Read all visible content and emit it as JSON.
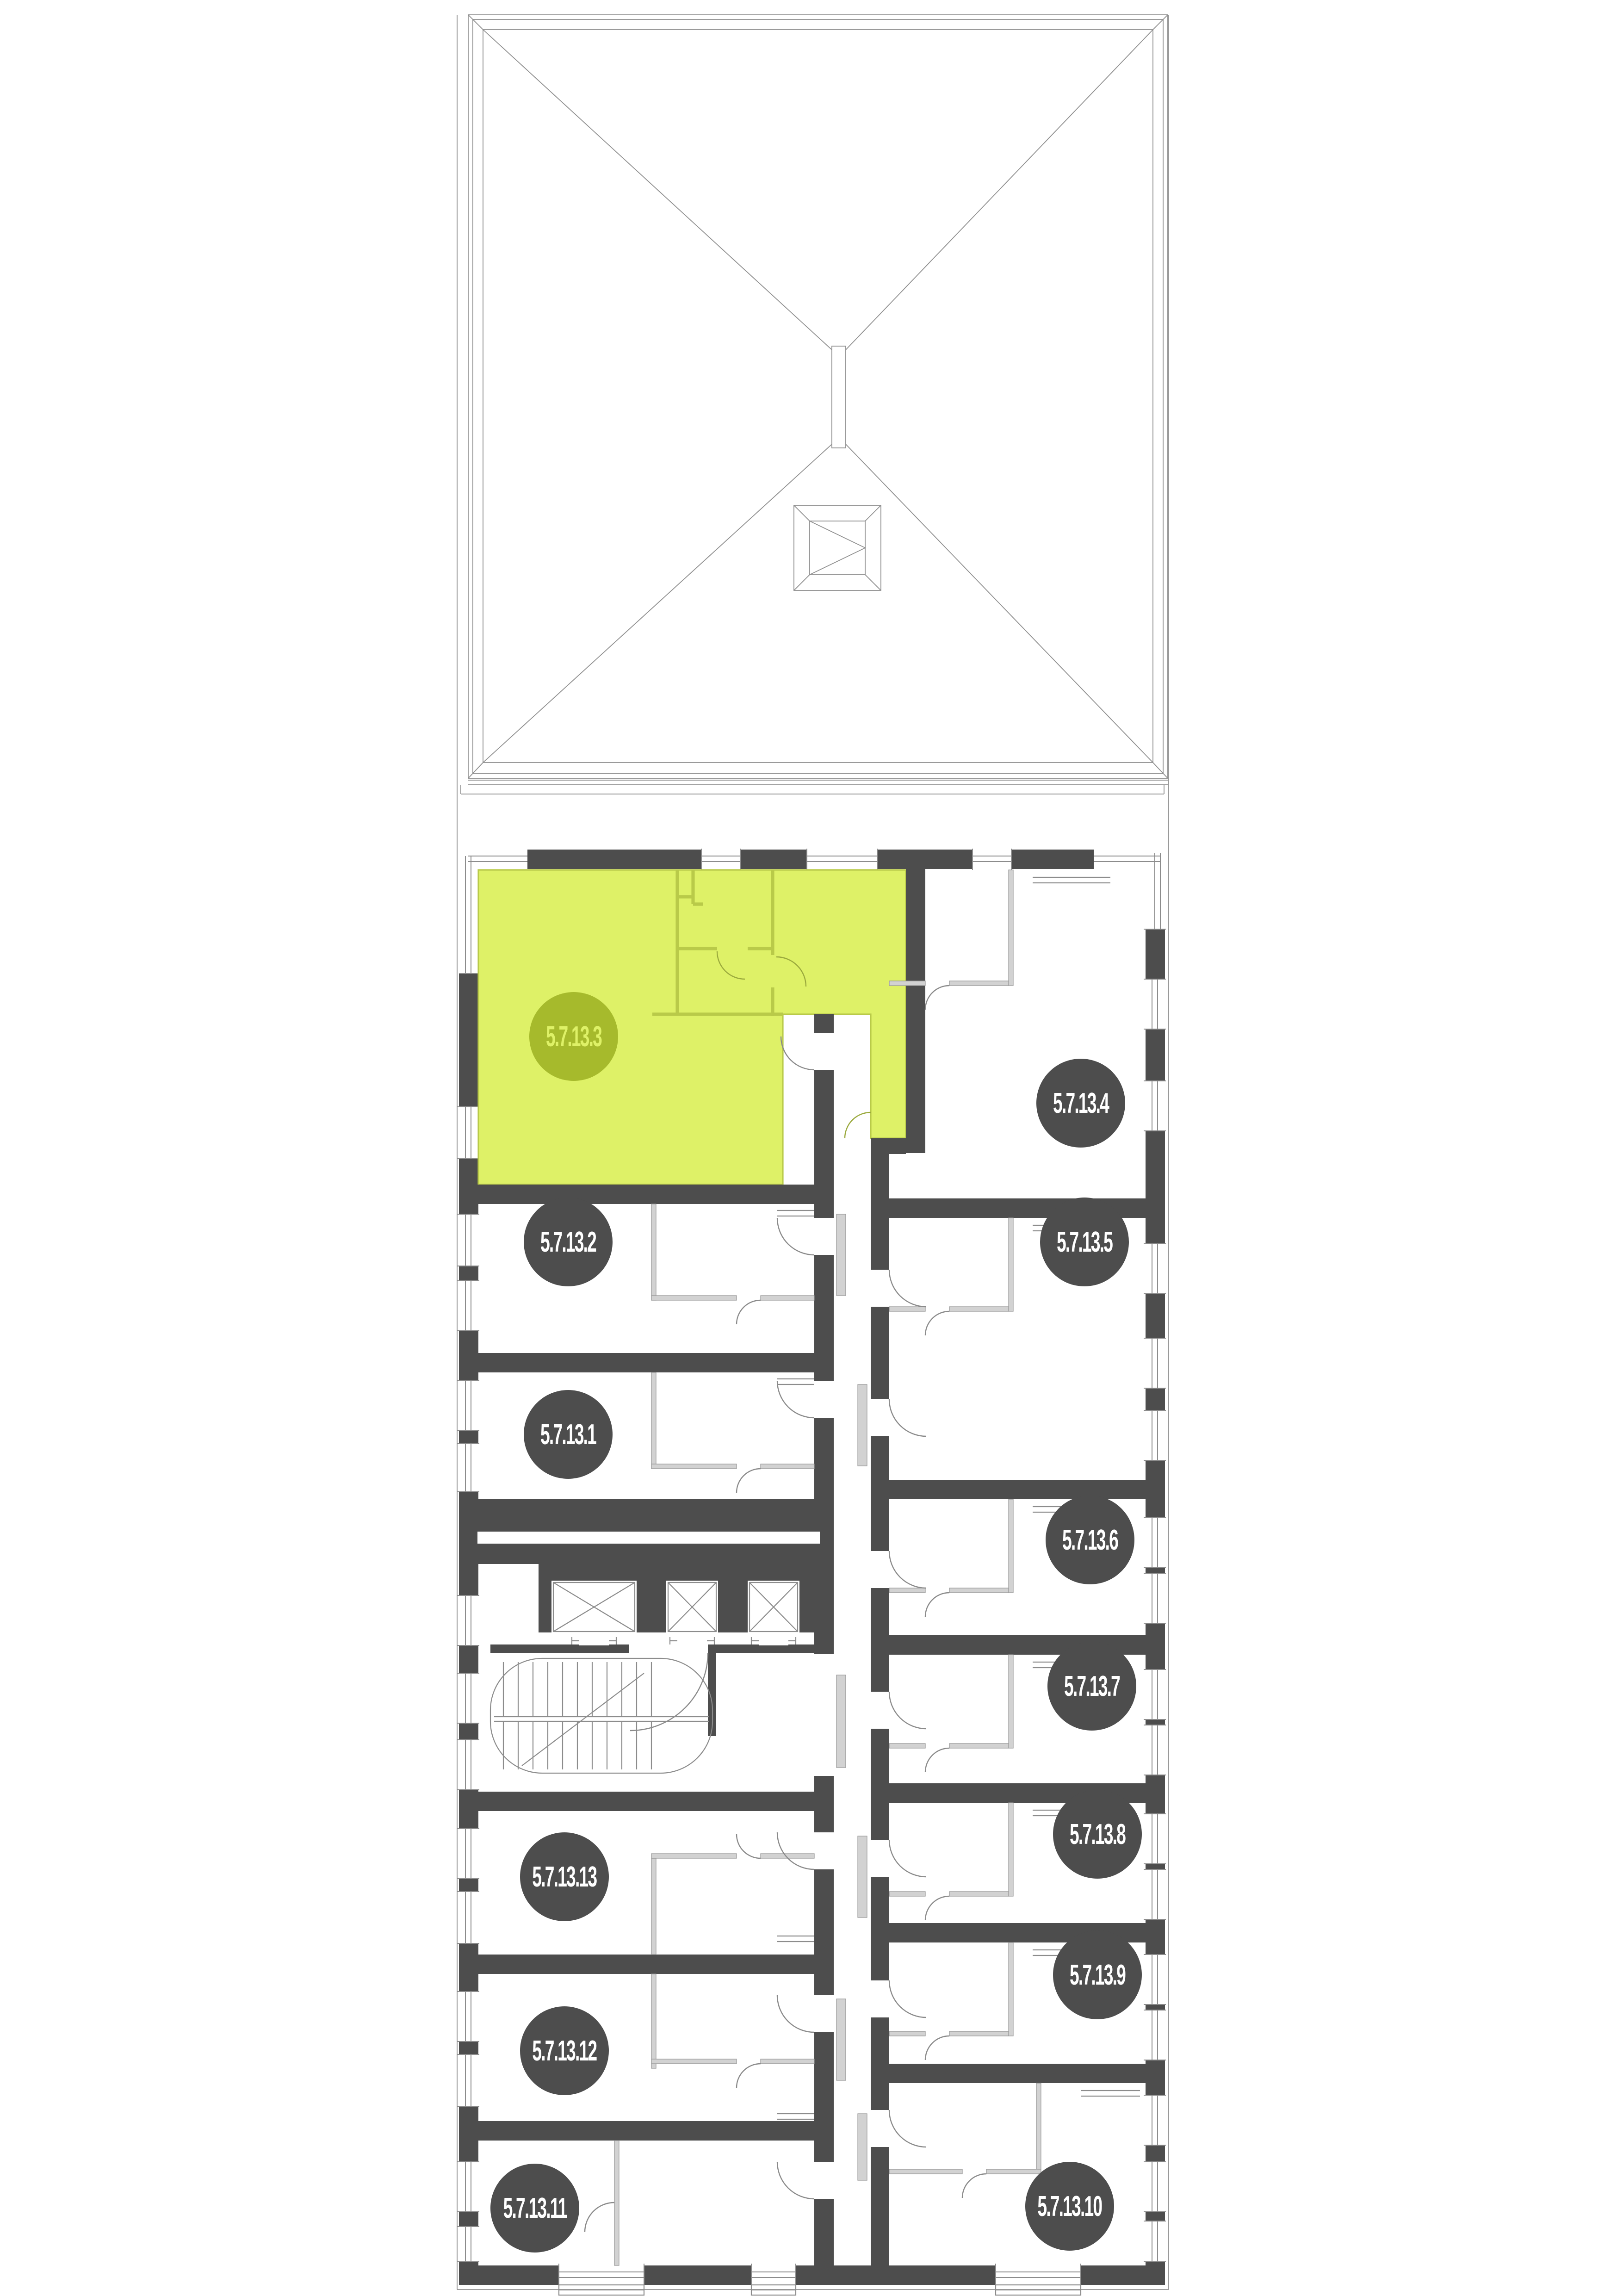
{
  "units": [
    {
      "id": "5.7.13.1",
      "label": "5.7.13.1",
      "highlighted": false
    },
    {
      "id": "5.7.13.2",
      "label": "5.7.13.2",
      "highlighted": false
    },
    {
      "id": "5.7.13.3",
      "label": "5.7.13.3",
      "highlighted": true
    },
    {
      "id": "5.7.13.4",
      "label": "5.7.13.4",
      "highlighted": false
    },
    {
      "id": "5.7.13.5",
      "label": "5.7.13.5",
      "highlighted": false
    },
    {
      "id": "5.7.13.6",
      "label": "5.7.13.6",
      "highlighted": false
    },
    {
      "id": "5.7.13.7",
      "label": "5.7.13.7",
      "highlighted": false
    },
    {
      "id": "5.7.13.8",
      "label": "5.7.13.8",
      "highlighted": false
    },
    {
      "id": "5.7.13.9",
      "label": "5.7.13.9",
      "highlighted": false
    },
    {
      "id": "5.7.13.10",
      "label": "5.7.13.10",
      "highlighted": false
    },
    {
      "id": "5.7.13.11",
      "label": "5.7.13.11",
      "highlighted": false
    },
    {
      "id": "5.7.13.12",
      "label": "5.7.13.12",
      "highlighted": false
    },
    {
      "id": "5.7.13.13",
      "label": "5.7.13.13",
      "highlighted": false
    }
  ],
  "highlighted_unit": "5.7.13.3",
  "colors": {
    "wall": "#4d4d4d",
    "highlight-fill": "#def167",
    "highlight-line": "#b9ca49",
    "highlight-badge": "#a6ba2c",
    "highlight-badge-text": "#def167",
    "badge": "#4d4d4d",
    "badge-text": "#ffffff",
    "partition": "#d2d2d2",
    "line": "#8c8c8c",
    "door": "#8a8a8a",
    "roof-line": "#8f8f8f",
    "bg": "#ffffff"
  },
  "icons": {
    "elevators": "elevator-shaft-icon",
    "staircase": "staircase-icon",
    "roof_hatch": "roof-hatch-icon"
  }
}
